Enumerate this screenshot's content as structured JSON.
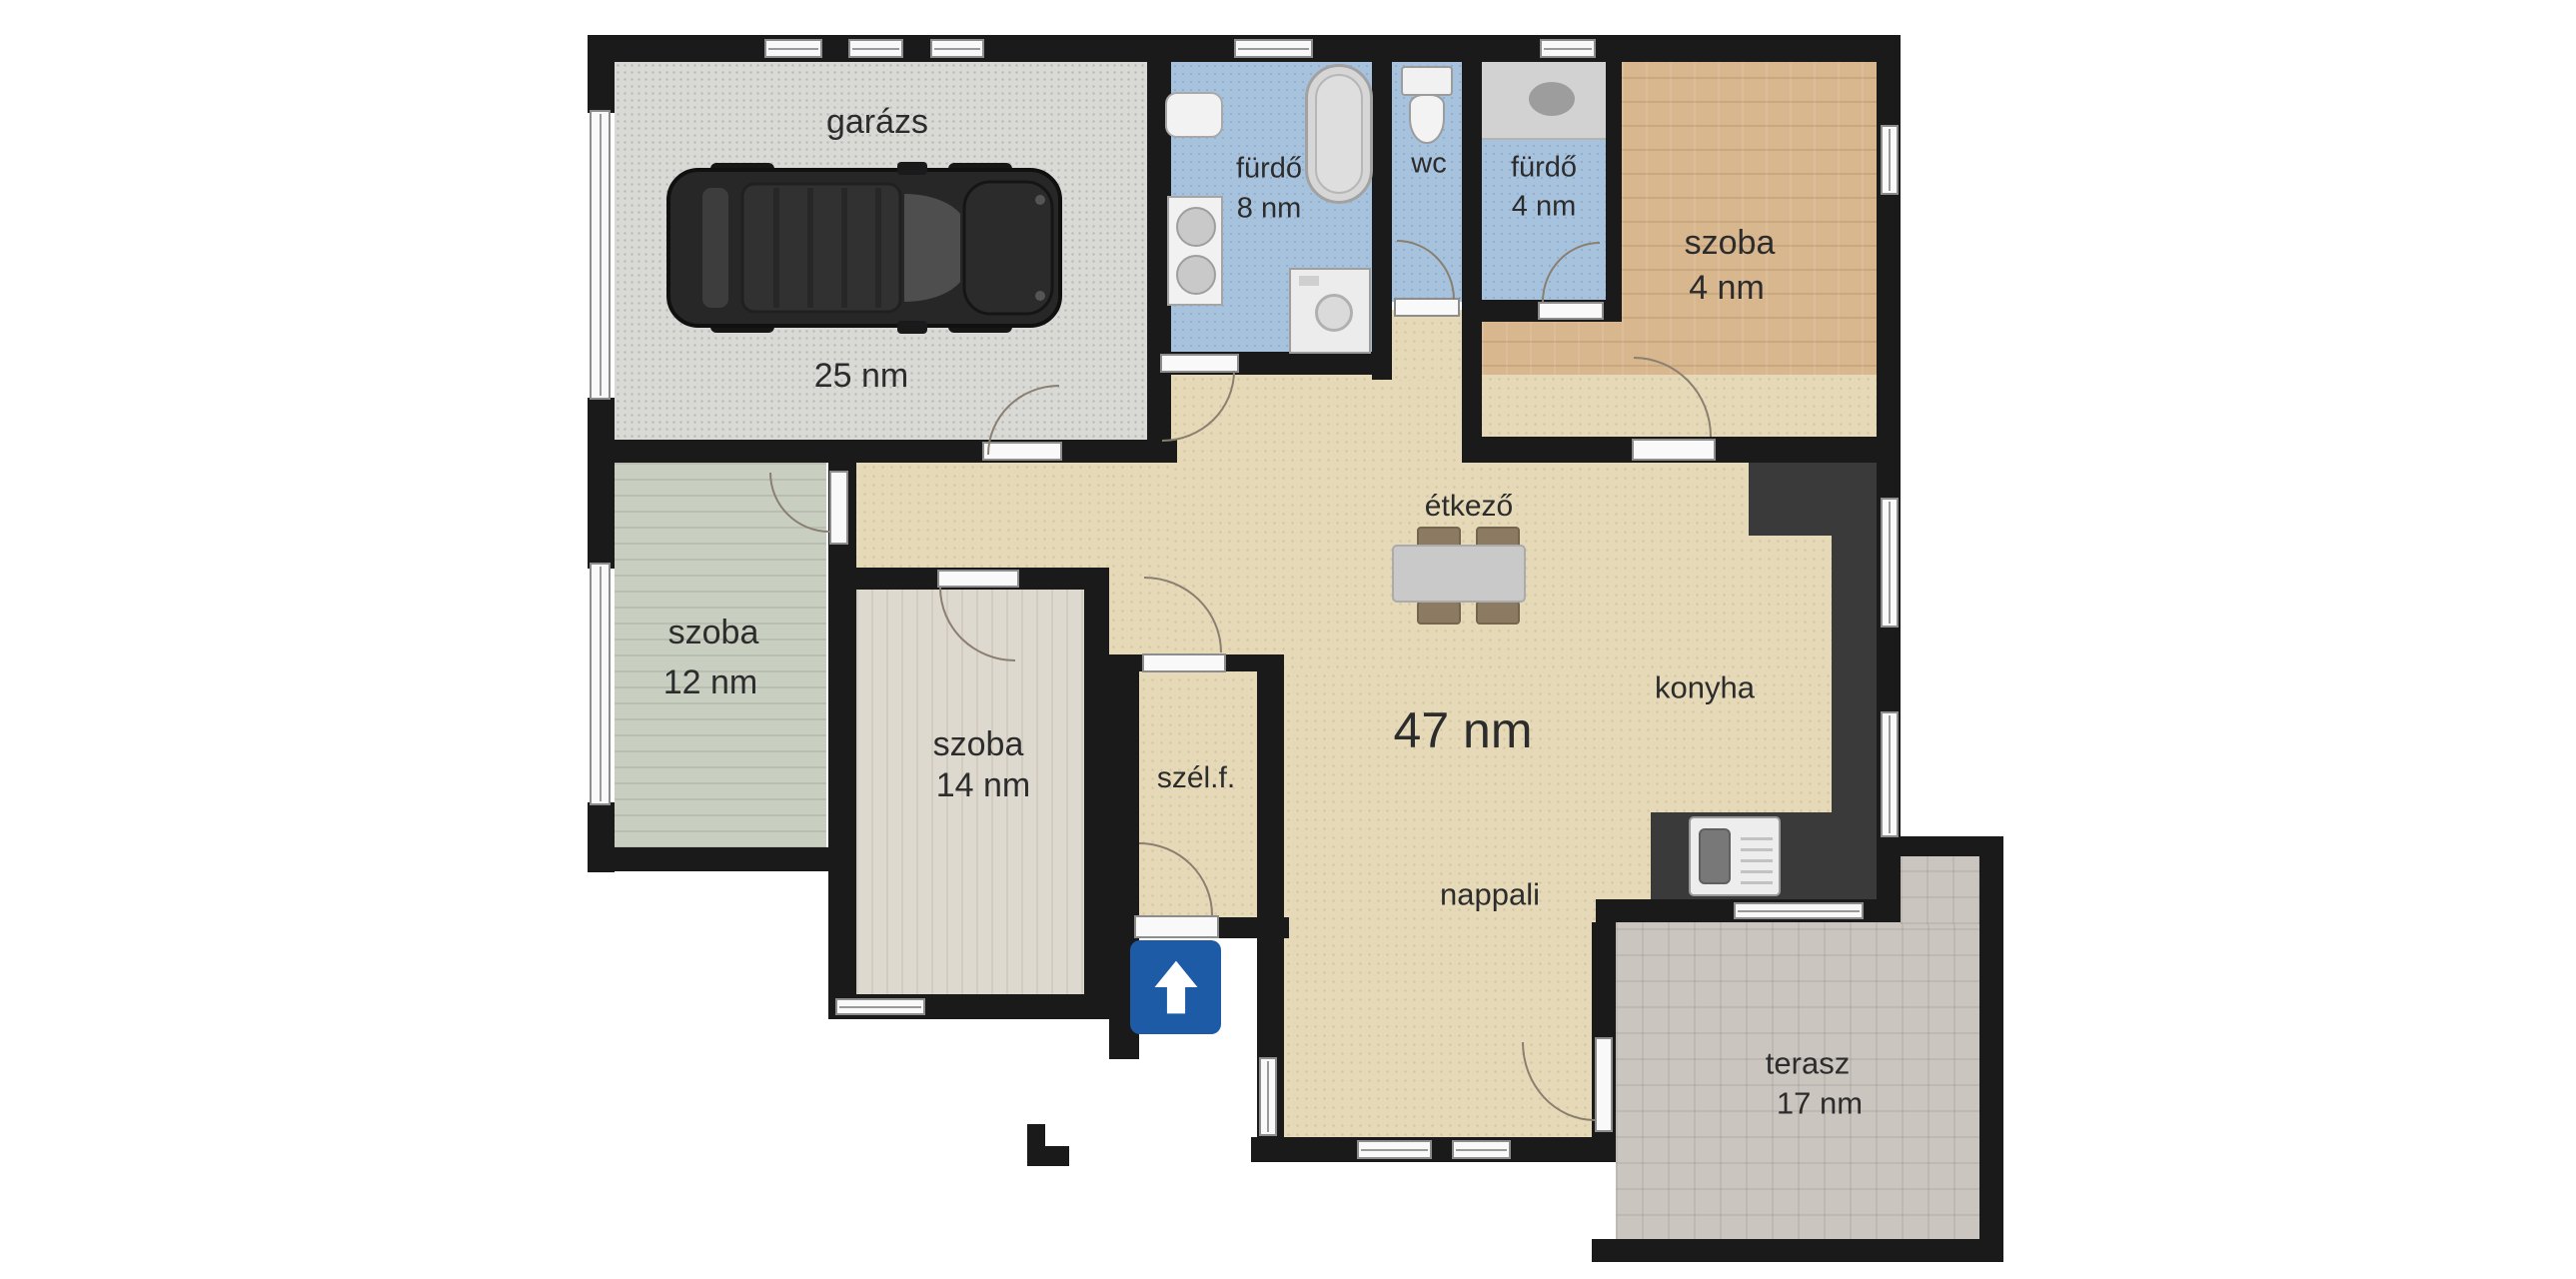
{
  "floorplan": {
    "language": "hu",
    "area_unit": "nm",
    "rooms": [
      {
        "id": "garazs",
        "label": "garázs",
        "area": "25 nm"
      },
      {
        "id": "furdo8",
        "label": "fürdő",
        "area": "8 nm"
      },
      {
        "id": "wc",
        "label": "wc",
        "area": ""
      },
      {
        "id": "furdo4",
        "label": "fürdő",
        "area": "4 nm"
      },
      {
        "id": "szoba4",
        "label": "szoba",
        "area": "4 nm"
      },
      {
        "id": "szoba12",
        "label": "szoba",
        "area": "12 nm"
      },
      {
        "id": "szoba14",
        "label": "szoba",
        "area": "14 nm"
      },
      {
        "id": "szelf",
        "label": "szél.f.",
        "area": ""
      },
      {
        "id": "etkezo",
        "label": "étkező",
        "area": ""
      },
      {
        "id": "open_space",
        "label": "",
        "area": "47 nm"
      },
      {
        "id": "konyha",
        "label": "konyha",
        "area": ""
      },
      {
        "id": "nappali",
        "label": "nappali",
        "area": ""
      },
      {
        "id": "terasz",
        "label": "terasz",
        "area": "17 nm"
      }
    ],
    "icons": [
      "car-icon",
      "bathtub-icon",
      "toilet-icon",
      "double-sink-icon",
      "washing-machine-icon",
      "shower-counter-icon",
      "dining-table-icon",
      "chair-icon",
      "kitchen-sink-icon",
      "entrance-arrow-icon"
    ],
    "colors": {
      "wall": "#1a1a1a",
      "floor_open": "#e5d9b8",
      "floor_garage": "#d9d9d6",
      "floor_bath": "#a7c2dd",
      "floor_szoba4": "#d8b68e",
      "floor_szoba12": "#c9cfc0",
      "floor_szoba14": "#ded9cf",
      "floor_terasz": "#cac5bf",
      "counter": "#3a3a3a",
      "opening": "#f9f9f9",
      "arc": "#8a7f70",
      "text": "#2c2c2c",
      "sign": "#1d5ba6"
    }
  }
}
